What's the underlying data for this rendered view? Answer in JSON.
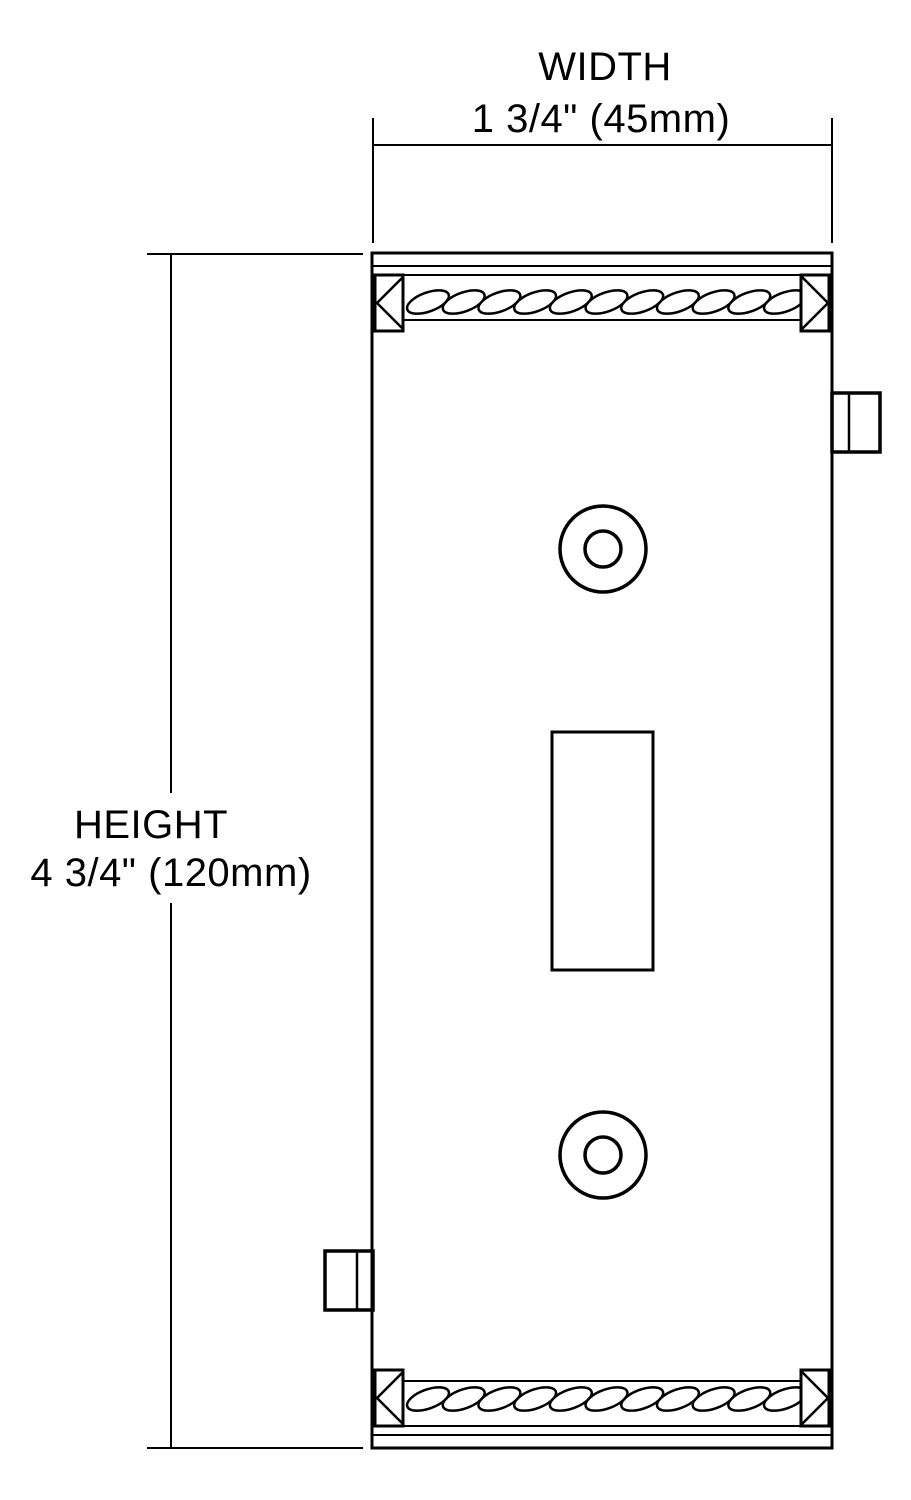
{
  "canvas": {
    "background": "#ffffff",
    "line_color": "#000000"
  },
  "drawing": {
    "kind": "product-dimension-diagram",
    "dimensions": {
      "width": {
        "label": "WIDTH",
        "value": "1 3/4\" (45mm)"
      },
      "height": {
        "label": "HEIGHT",
        "value": "4 3/4\" (120mm)"
      }
    }
  }
}
